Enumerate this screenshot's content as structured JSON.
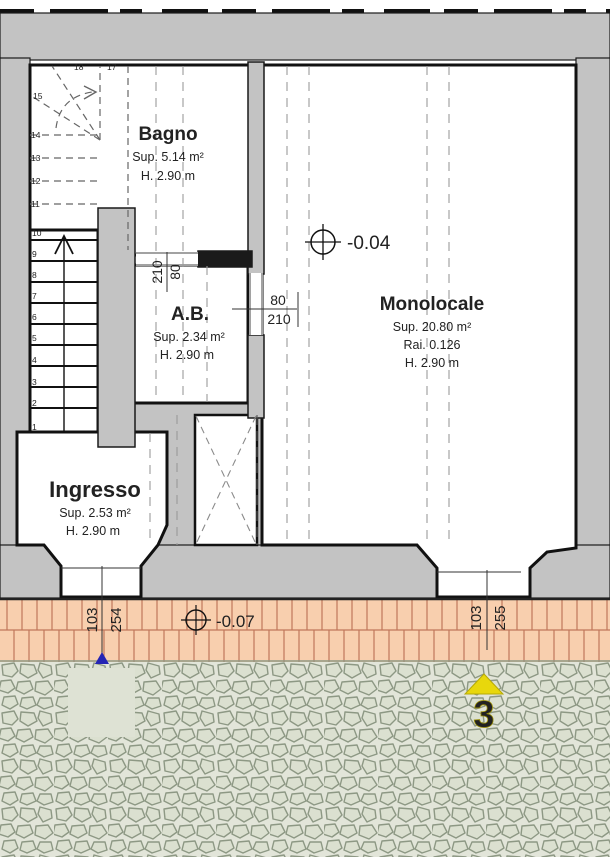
{
  "title": "Floor plan",
  "rooms": {
    "bagno": {
      "name": "Bagno",
      "sup": "Sup. 5.14 m²",
      "h": "H. 2.90 m"
    },
    "ab": {
      "name": "A.B.",
      "sup": "Sup. 2.34 m²",
      "h": "H. 2.90 m"
    },
    "monolocale": {
      "name": "Monolocale",
      "sup": "Sup. 20.80 m²",
      "rai": "Rai. 0.126",
      "h": "H. 2.90 m"
    },
    "ingresso": {
      "name": "Ingresso",
      "sup": "Sup. 2.53 m²",
      "h": "H. 2.90 m"
    }
  },
  "levels": {
    "interior": "-0.04",
    "exterior": "-0.07"
  },
  "doors": {
    "bagno_ab": {
      "width": "80",
      "height": "210"
    },
    "ab_monolocale": {
      "width": "80",
      "height": "210"
    },
    "entry_ingresso": {
      "width": "103",
      "height": "254"
    },
    "entry_monolocale": {
      "width": "103",
      "height": "255"
    }
  },
  "stairs": {
    "numbers": [
      "1",
      "2",
      "3",
      "4",
      "5",
      "6",
      "7",
      "8",
      "9",
      "10",
      "11",
      "12",
      "13",
      "14",
      "15",
      "17",
      "18"
    ]
  },
  "site": {
    "north_label": "3"
  },
  "colors": {
    "wall": "#c3c3c3",
    "line": "#1a1a1a",
    "paving_fill": "#f8cfae",
    "paving_joint": "#c0765a",
    "cobble_bg": "#e2e5d9",
    "cobble_stone": "#dbe0d0",
    "cobble_outline": "#8d9884",
    "plain_patch": "#dee2d4",
    "arrow_yellow": "#e8d70c",
    "marker_blue": "#2424b4"
  }
}
